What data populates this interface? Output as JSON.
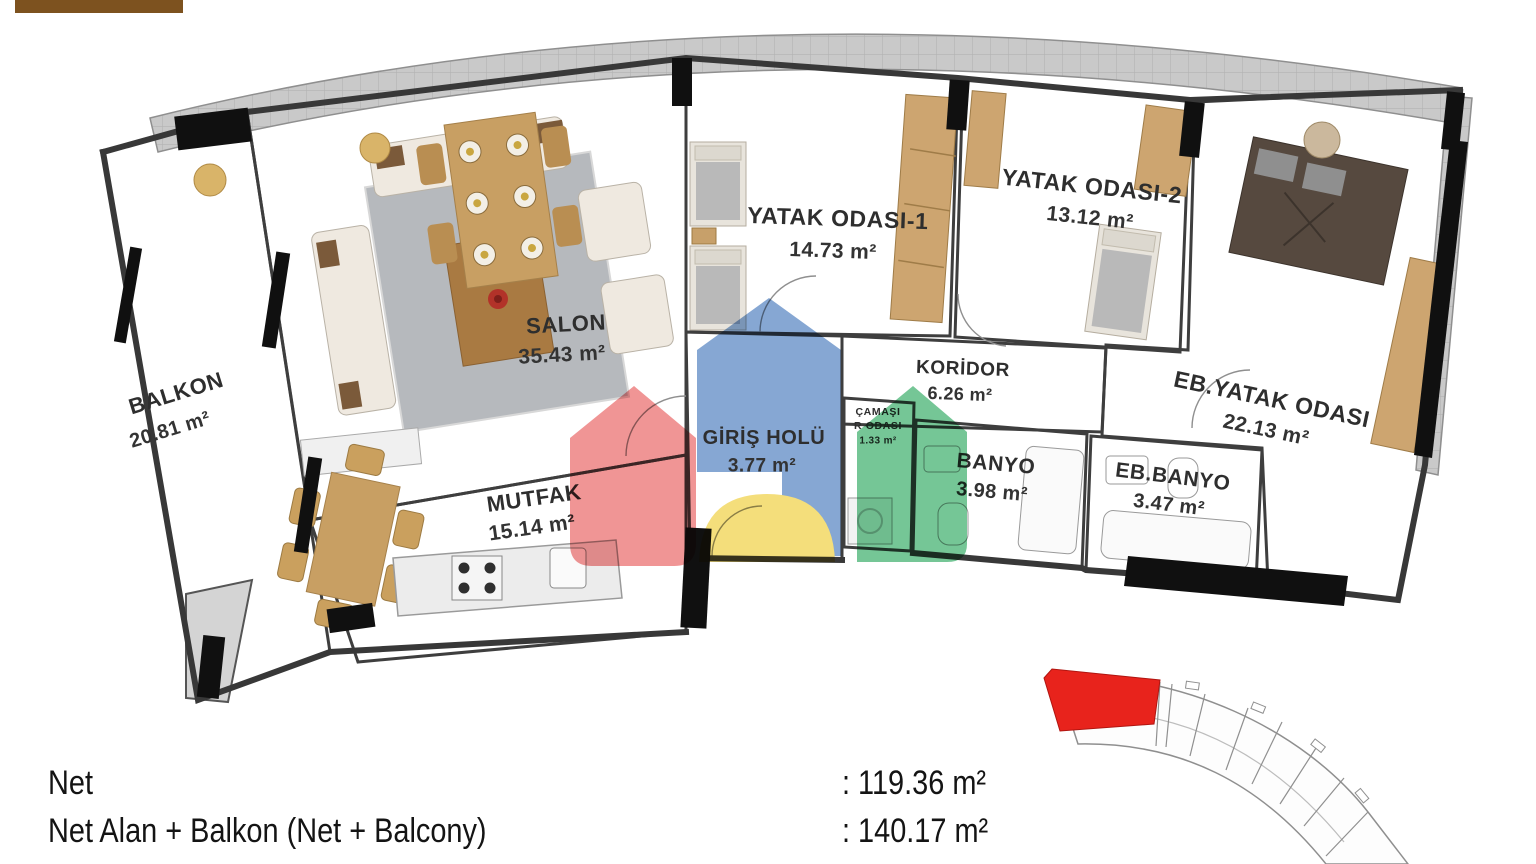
{
  "floor_plan": {
    "rooms": {
      "balkon": {
        "name": "BALKON",
        "area": "20.81 m²"
      },
      "salon": {
        "name": "SALON",
        "area": "35.43 m²"
      },
      "mutfak": {
        "name": "MUTFAK",
        "area": "15.14 m²"
      },
      "yatak1": {
        "name": "YATAK ODASI-1",
        "area": "14.73 m²"
      },
      "yatak2": {
        "name": "YATAK ODASI-2",
        "area": "13.12 m²"
      },
      "koridor": {
        "name": "KORİDOR",
        "area": "6.26 m²"
      },
      "giris": {
        "name": "GİRİŞ HOLÜ",
        "area": "3.77 m²"
      },
      "camasir": {
        "line1": "ÇAMAŞI",
        "line2": "R ODASI",
        "area": "1.33 m²"
      },
      "banyo": {
        "name": "BANYO",
        "area": "3.98 m²"
      },
      "eb_banyo": {
        "name": "EB.BANYO",
        "area": "3.47 m²"
      },
      "eb_yatak": {
        "name": "EB.YATAK ODASI",
        "area": "22.13 m²"
      }
    }
  },
  "summary": {
    "net_label": "Net",
    "net_value": ": 119.36 m²",
    "net_balkon_label": "Net Alan + Balkon (Net + Balcony)",
    "net_balkon_value": ": 140.17 m²"
  },
  "colors": {
    "accent_brown": "#7d521f",
    "wood_floor": "#d7b183",
    "tile_gray": "#d9d9d9",
    "wall": "#3e3e3e",
    "watermark_red": "#ed7d7d",
    "watermark_blue": "#6b94ca",
    "watermark_green": "#56b97f",
    "watermark_yellow": "#f2d75e",
    "key_plan_highlight": "#e8231c",
    "giris_label_blue": "#35639f"
  }
}
